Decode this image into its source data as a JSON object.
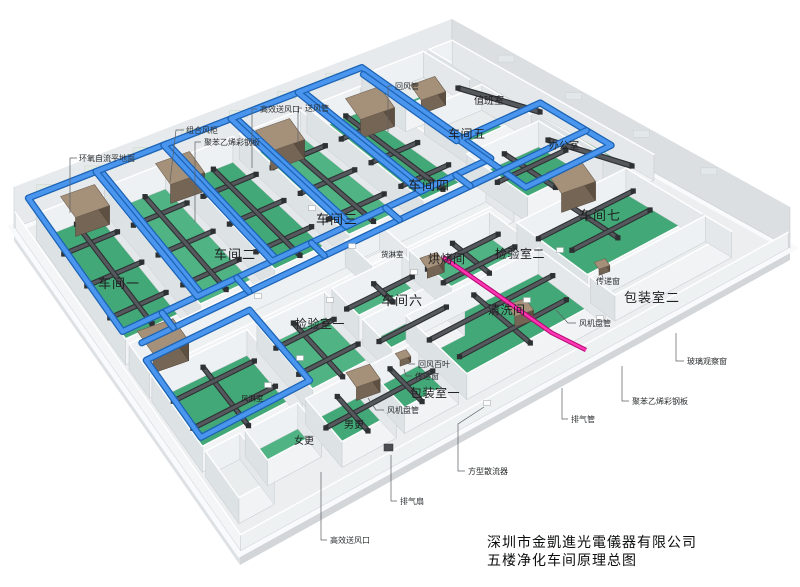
{
  "drawing": {
    "company": "深圳市金凱進光電儀器有限公司",
    "title": "五楼净化车间原理总图"
  },
  "rooms": {
    "workshop1": "车间一",
    "workshop2": "车间二",
    "workshop3": "车间三",
    "workshop4": "车间四",
    "workshop5": "车间五",
    "workshop6": "车间六",
    "workshop7": "车间七",
    "inspection1": "检验室一",
    "inspection2": "检验室二",
    "baking": "烘烤间",
    "cleaning": "清洗间",
    "cargo_shower": "货淋室",
    "air_shower": "风淋室",
    "packing1": "包装室一",
    "packing2": "包装室二",
    "men_change": "男更",
    "women_change": "女更",
    "office": "办公室",
    "duty_room": "值班室"
  },
  "callouts": {
    "epoxy_floor": "环氧自流平地面",
    "air_cabinet": "组合风柜",
    "steel_panel_top": "聚苯乙烯彩钢板",
    "hepa_outlet_top": "高效送风口",
    "supply_duct": "送风管",
    "return_duct": "回风管",
    "glass_window": "玻璃观察窗",
    "steel_panel_right": "聚苯乙烯彩钢板",
    "exhaust_pipe": "排气管",
    "fan_coil_right": "风机盘管",
    "fan_coil_left": "风机盘管",
    "return_louver": "回风百叶",
    "transfer_window_mid": "传递窗",
    "transfer_window_right": "传递窗",
    "square_diffuser": "方型散流器",
    "exhaust_fan": "排气扇",
    "hepa_outlet_bottom": "高效送风口"
  },
  "colors": {
    "floor_green": "#43a877",
    "floor_green_light": "#4fb383",
    "duct_blue": "#4a96ef",
    "duct_dark": "#44474a",
    "exhaust_pink": "#ff35b1",
    "ahu_brown": "#a5917a",
    "wall_light": "#eef0f2"
  }
}
